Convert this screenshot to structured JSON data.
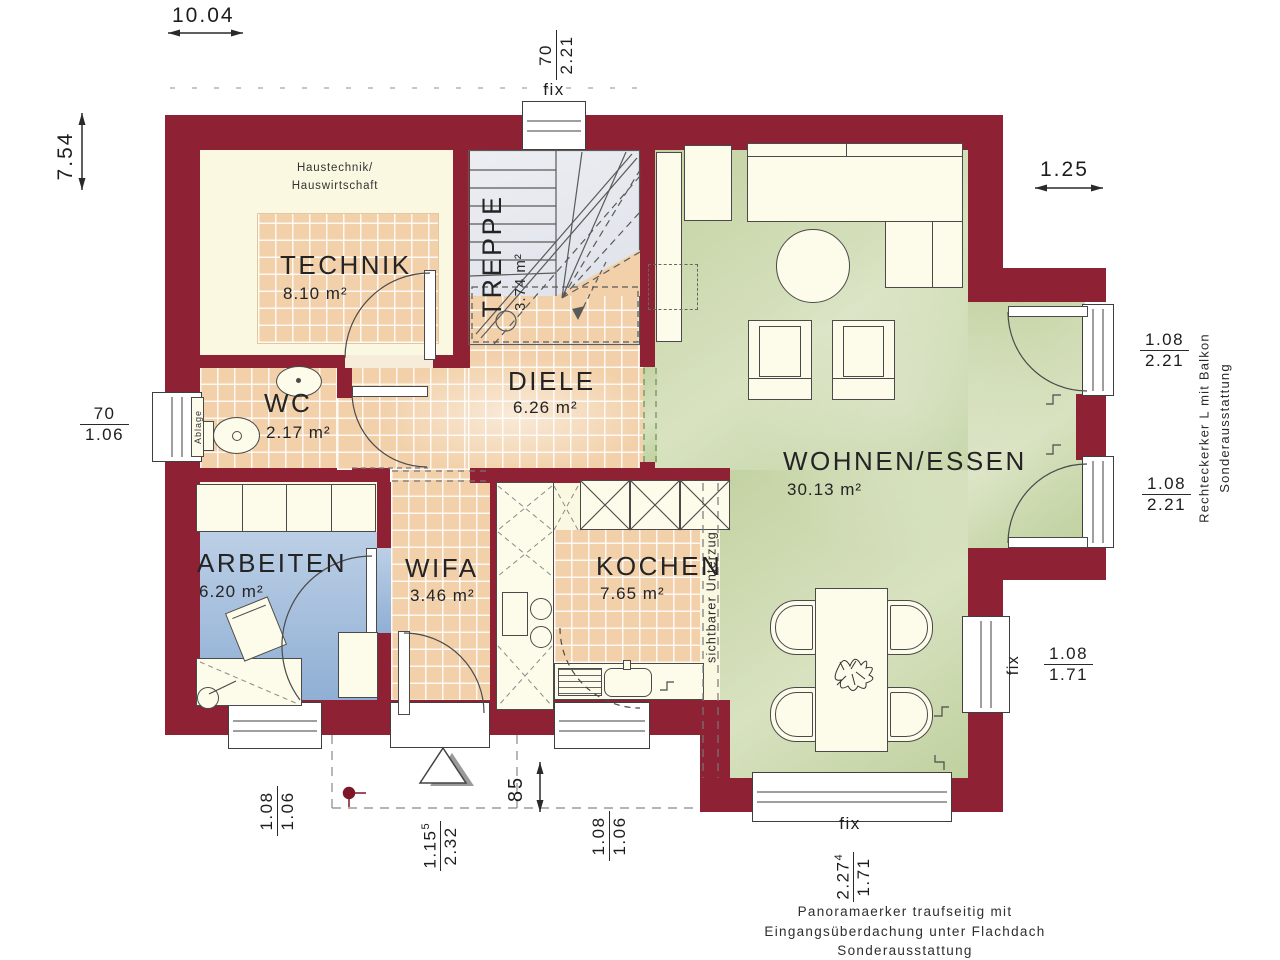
{
  "meta": {
    "type": "architectural floor plan (ground floor)"
  },
  "rooms": {
    "technik": {
      "name": "TECHNIK",
      "area": "8.10 m²",
      "note_line1": "Haustechnik/",
      "note_line2": "Hauswirtschaft"
    },
    "treppe": {
      "name": "TREPPE",
      "area": "3.74 m²"
    },
    "wc": {
      "name": "WC",
      "area": "2.17 m²",
      "shelf_label": "Ablage"
    },
    "diele": {
      "name": "DIELE",
      "area": "6.26 m²"
    },
    "arbeiten": {
      "name": "ARBEITEN",
      "area": "6.20 m²"
    },
    "wifa": {
      "name": "WIFA",
      "area": "3.46 m²"
    },
    "kochen": {
      "name": "KOCHEN",
      "area": "7.65 m²",
      "beam_label": "sichtbarer Unterzug"
    },
    "wohnen_essen": {
      "name": "WOHNEN/ESSEN",
      "area": "30.13 m²"
    }
  },
  "dimensions": {
    "overall_width": "10.04",
    "overall_height": "7.54",
    "erker_offset": "1.25",
    "canopy_depth": "85",
    "window_top": {
      "num": "70",
      "den": "2.21"
    },
    "window_wc": {
      "num": "70",
      "den": "1.06"
    },
    "bay_door_upper": {
      "num": "1.08",
      "den": "2.21"
    },
    "bay_door_lower": {
      "num": "1.08",
      "den": "2.21"
    },
    "window_right": {
      "num": "1.08",
      "den": "1.71"
    },
    "window_arbeiten": {
      "num": "1.08",
      "den": "1.06"
    },
    "entry_door": {
      "num": "1.15",
      "sup": "5",
      "den": "2.32"
    },
    "window_kitchen": {
      "num": "1.08",
      "den": "1.06"
    },
    "panorama_window": {
      "num": "2.27",
      "sup": "4",
      "den": "1.71"
    }
  },
  "labels": {
    "fix_top": "fix",
    "fix_right": "fix",
    "fix_bottom": "fix",
    "bay_note_line1": "Rechteckerker L mit Balkon",
    "bay_note_line2": "Sonderausstattung",
    "panorama_note_line1": "Panoramaerker traufseitig mit",
    "panorama_note_line2": "Eingangsüberdachung unter Flachdach",
    "panorama_note_line3": "Sonderausstattung"
  },
  "colors": {
    "wall": "#8e2133",
    "tile_floor": "#f2d1aa",
    "living_green": "#c7d5a7",
    "work_blue": "#a9c0dd",
    "stair_gray": "#e8eaef",
    "room_cream": "#fbf8e2"
  }
}
